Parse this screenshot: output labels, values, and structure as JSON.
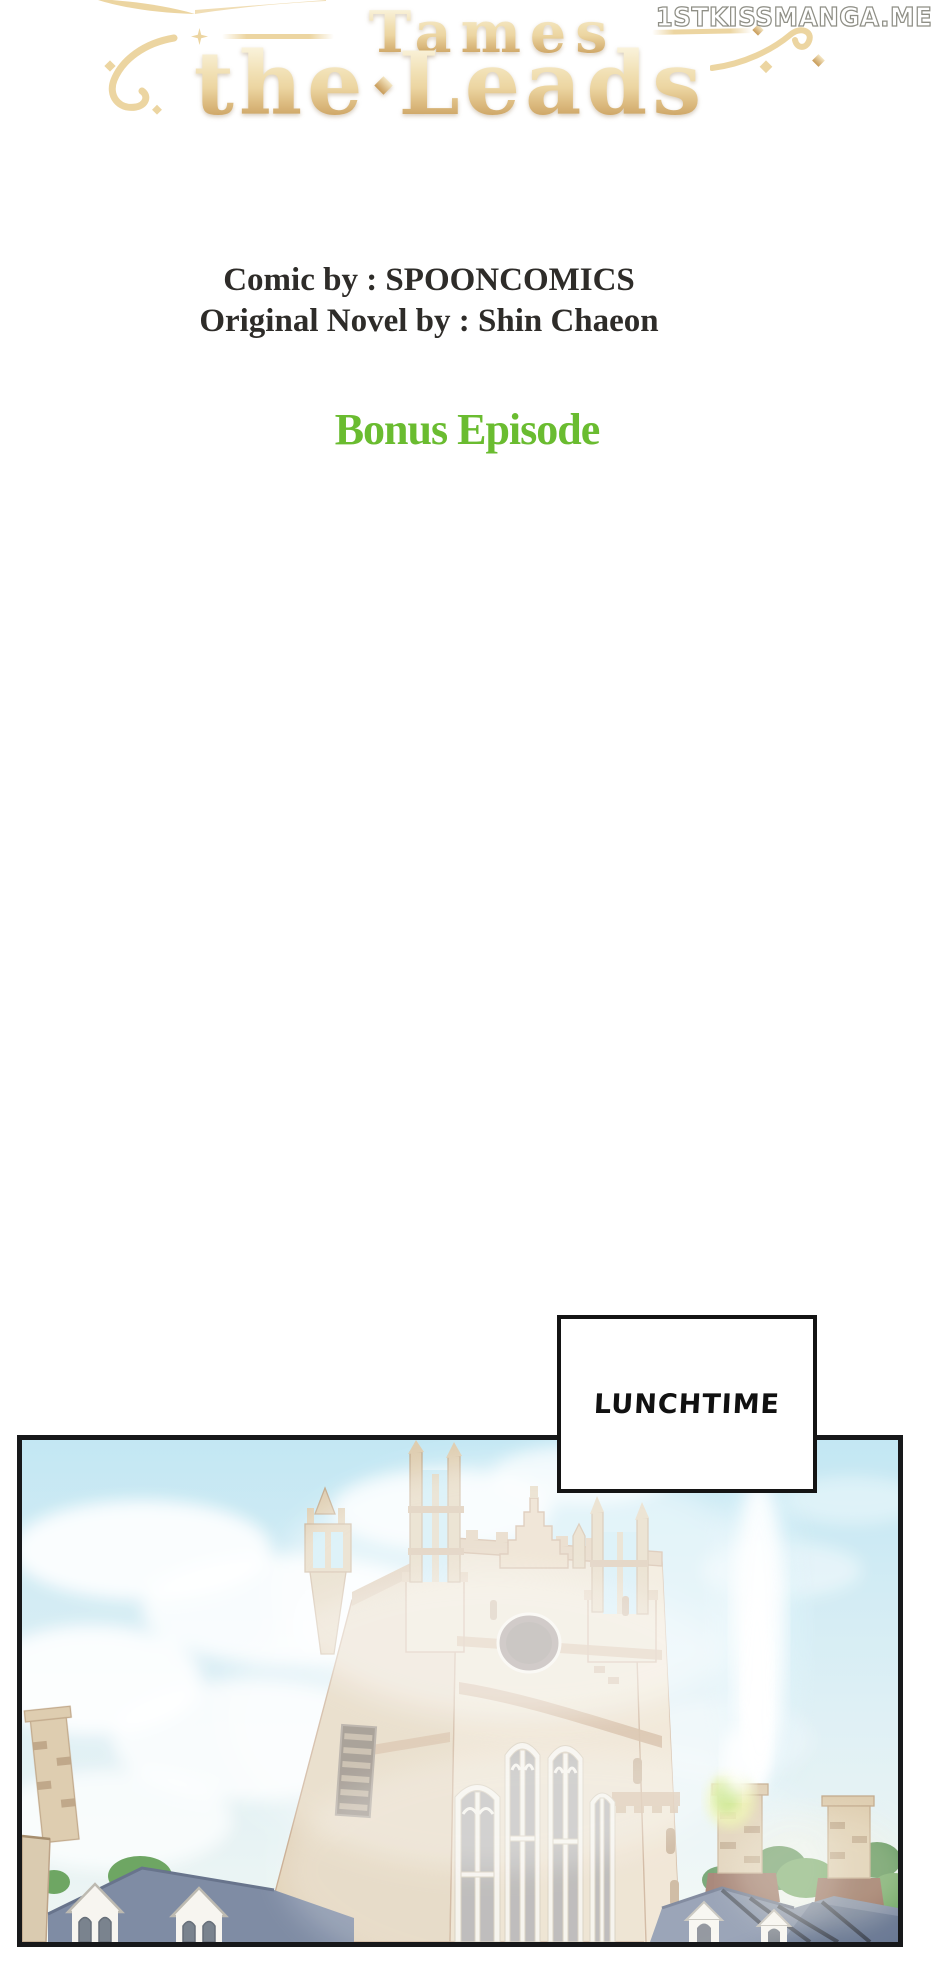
{
  "watermark": {
    "text": "1STKISSMANGA.ME"
  },
  "title_logo": {
    "line1": "Tames",
    "line2_left": "the",
    "line2_right": "Leads"
  },
  "credits": {
    "comic_by": "Comic by : SPOONCOMICS",
    "novel_by": "Original Novel by : Shin Chaeon"
  },
  "episode": {
    "label": "Bonus Episode"
  },
  "speech": {
    "lunchtime": "LUNCHTIME"
  },
  "theme": {
    "gold-light": "#faf3dc",
    "gold-mid": "#ecd5a1",
    "gold-dark": "#c89b58",
    "ink": "#2e2c29",
    "episode-green": "#6abc30",
    "panel-border": "#17181a",
    "sky-top": "#bfe6f3",
    "sky-low": "#eef6f3",
    "wall": "#e9dcc5",
    "wall-shade": "#e0d0b5",
    "wall-trim": "#c9a987",
    "wall-outline": "#c3a385",
    "glass": "#a8a6a4",
    "frame-white": "#f4f1e9",
    "oval-window": "#80716a",
    "roof": "#76849e",
    "roof-dark": "#2f3644",
    "dormer": "#f7f5ef",
    "tree": "#63a058",
    "tree-dark": "#4c8a4a",
    "chimney": "#dccaab",
    "chimney-base": "#8a5e4b",
    "flare-green": "#b8df66",
    "flare-yellow": "#e9f29b"
  }
}
